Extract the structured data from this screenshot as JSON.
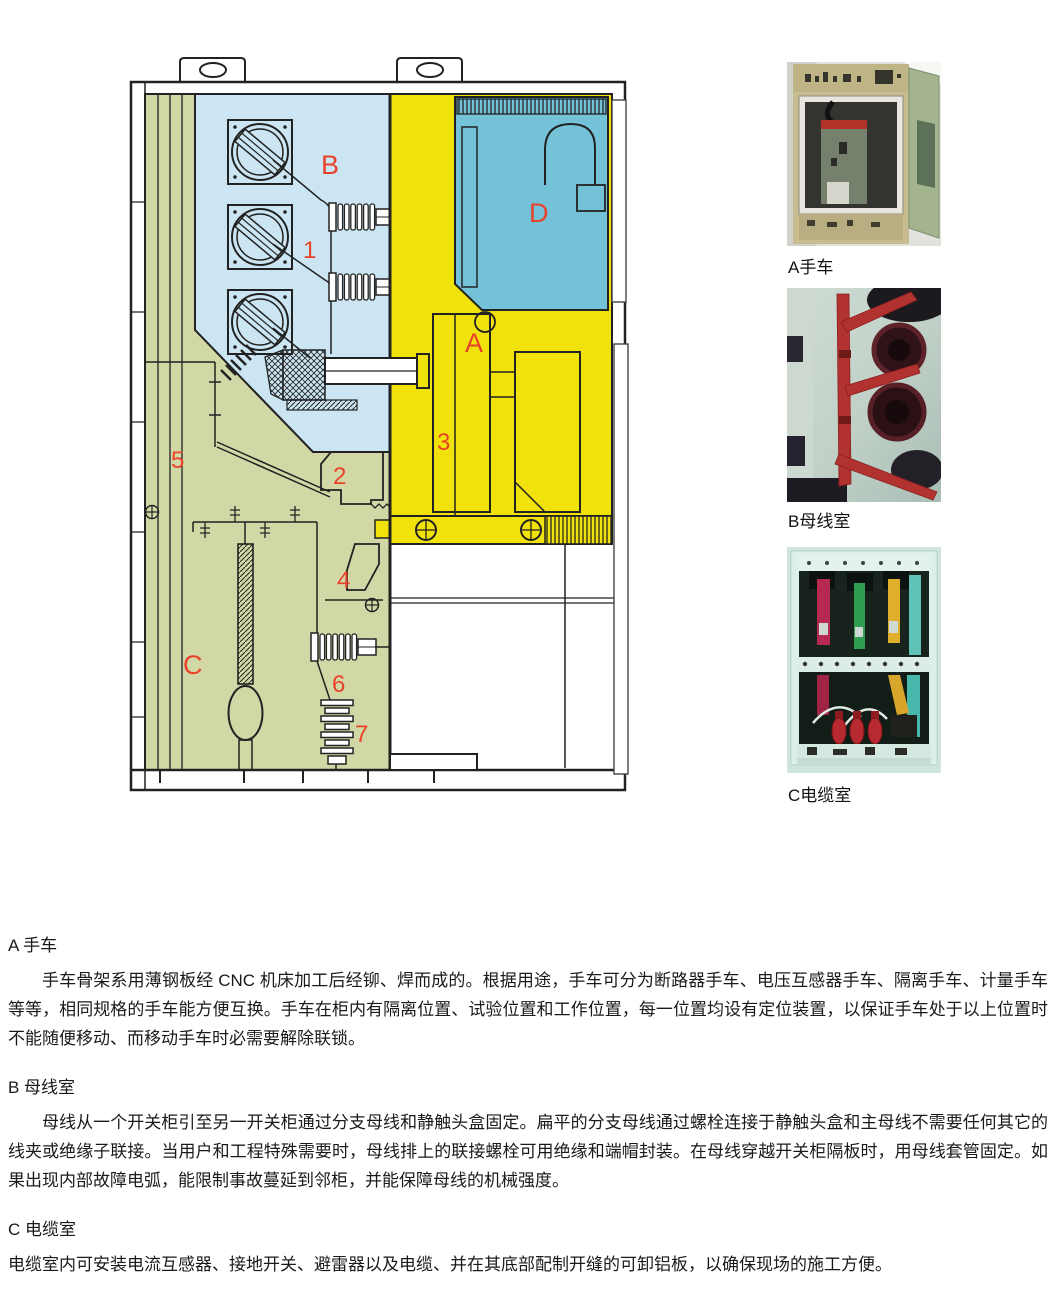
{
  "diagram": {
    "labels": {
      "A": "A",
      "B": "B",
      "C": "C",
      "D": "D",
      "n1": "1",
      "n2": "2",
      "n3": "3",
      "n4": "4",
      "n5": "5",
      "n6": "6",
      "n7": "7"
    },
    "colors": {
      "busbar_room_blue": "#cbe6f2",
      "handcart_room_yellow": "#f0e20a",
      "cable_room_olive": "#d2d7a6",
      "lv_room_teal": "#74c2d8",
      "label_red": "#e8432a",
      "line": "#1a1a1a"
    }
  },
  "photos": [
    {
      "caption": "A手车"
    },
    {
      "caption": "B母线室"
    },
    {
      "caption": "C电缆室"
    }
  ],
  "sections": [
    {
      "heading": "A 手车",
      "indent": true,
      "body": "手车骨架系用薄钢板经 CNC 机床加工后经铆、焊而成的。根据用途，手车可分为断路器手车、电压互感器手车、隔离手车、计量手车等等，相同规格的手车能方便互换。手车在柜内有隔离位置、试验位置和工作位置，每一位置均设有定位装置，以保证手车处于以上位置时不能随便移动、而移动手车时必需要解除联锁。"
    },
    {
      "heading": "B 母线室",
      "indent": true,
      "body": "母线从一个开关柜引至另一开关柜通过分支母线和静触头盒固定。扁平的分支母线通过螺栓连接于静触头盒和主母线不需要任何其它的线夹或绝缘子联接。当用户和工程特殊需要时，母线排上的联接螺栓可用绝缘和端帽封装。在母线穿越开关柜隔板时，用母线套管固定。如果出现内部故障电弧，能限制事故蔓延到邻柜，并能保障母线的机械强度。"
    },
    {
      "heading": "C 电缆室",
      "indent": false,
      "body": "电缆室内可安装电流互感器、接地开关、避雷器以及电缆、并在其底部配制开缝的可卸铝板，以确保现场的施工方便。"
    }
  ]
}
